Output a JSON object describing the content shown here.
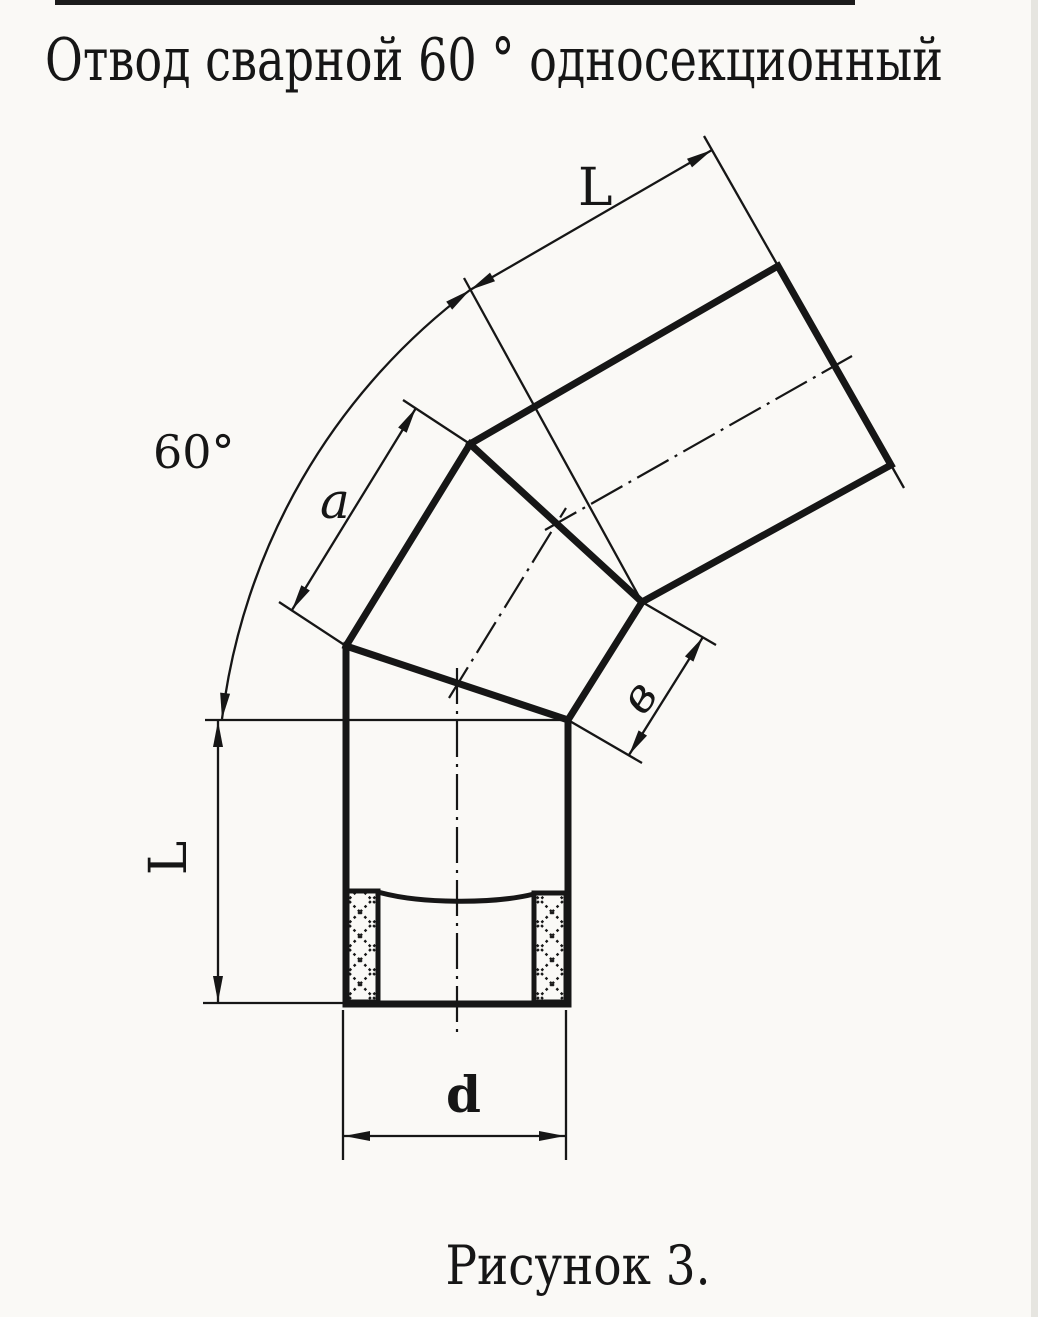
{
  "title": "Отвод сварной 60 ° односекционный",
  "caption": "Рисунок 3.",
  "labels": {
    "top_length": "L",
    "angle": "60°",
    "segment_outer": "a",
    "segment_inner": "в",
    "left_length": "L",
    "diameter": "d"
  },
  "colors": {
    "ink": "#161616",
    "paper": "#faf9f6"
  }
}
